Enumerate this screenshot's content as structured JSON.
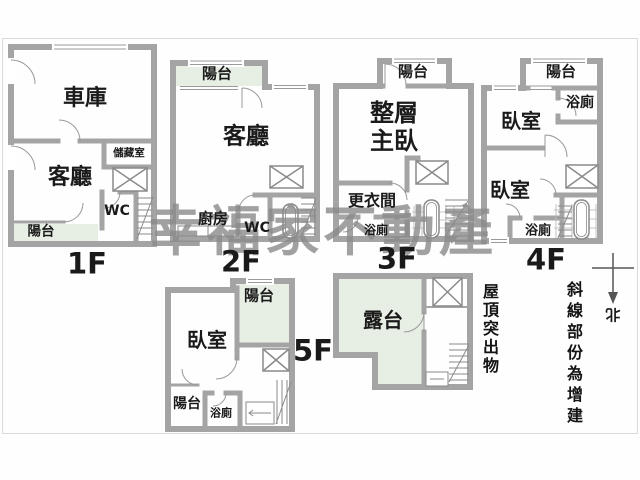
{
  "watermark": "幸福家不動產",
  "colors": {
    "wall": "#a4a4a4",
    "balcony": "#e7eee3",
    "fixture": "#8a8a8a",
    "door": "#999999",
    "hatch": "#b5b5b5",
    "north": "#555555"
  },
  "floors": {
    "f1": {
      "label": "1F",
      "garage": "車庫",
      "living": "客廳",
      "storage": "儲藏室",
      "wc": "WC",
      "balcony": "陽台"
    },
    "f2": {
      "label": "2F",
      "balcony": "陽台",
      "living": "客廳",
      "kitchen": "廚房",
      "wc": "WC"
    },
    "f3": {
      "label": "3F",
      "balcony": "陽台",
      "master_line1": "整層",
      "master_line2": "主臥",
      "dressing": "更衣間",
      "bath": "浴廁"
    },
    "f4": {
      "label": "4F",
      "balcony": "陽台",
      "bath_top": "浴廁",
      "bedroom_top": "臥室",
      "bedroom_bottom": "臥室",
      "bath_bottom": "浴廁"
    },
    "f5": {
      "label": "5F",
      "balcony_top": "陽台",
      "bedroom": "臥室",
      "balcony_bottom": "陽台",
      "bath": "浴廁"
    },
    "roof": {
      "terrace": "露台",
      "note": "屋頂突出物"
    }
  },
  "annotations": {
    "hatch_note": "斜線部份為增建",
    "compass_north": "北"
  }
}
